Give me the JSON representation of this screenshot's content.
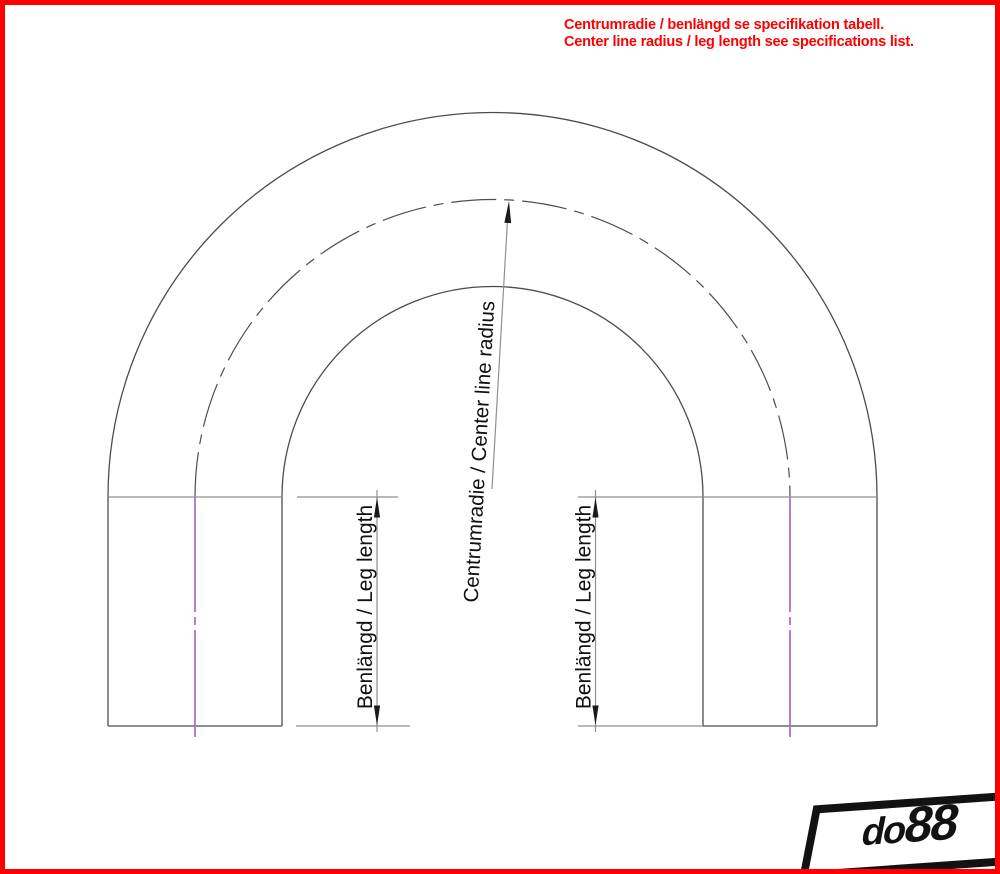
{
  "annotation": {
    "line1": "Centrumradie / benlängd se specifikation tabell.",
    "line2": "Center line radius / leg length see specifications list.",
    "color": "#ff0000"
  },
  "drawing": {
    "labels": {
      "center_line_radius": "Centrumradie / Center line radius",
      "leg_length_left": "Benlängd / Leg length",
      "leg_length_right": "Benlängd / Leg length"
    },
    "colors": {
      "outline": "#4d4d4d",
      "dimension_lines": "#8f8f8f",
      "arrowheads": "#1a1a1a",
      "leg_centerline": "#b56fc9",
      "frame_red": "#fe0000"
    }
  },
  "logo": {
    "prefix": "do",
    "suffix": "88"
  }
}
